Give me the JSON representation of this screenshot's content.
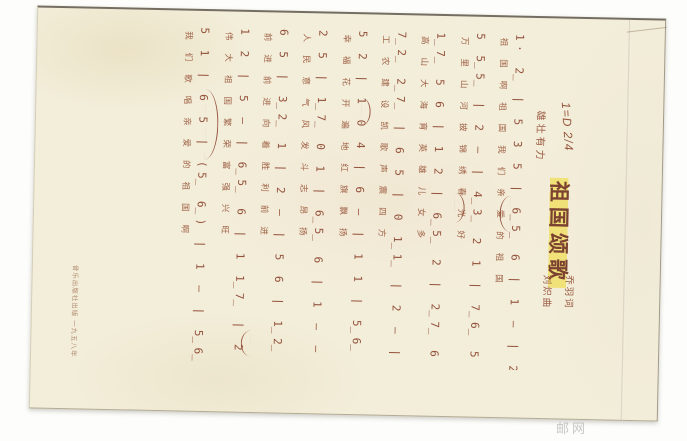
{
  "sheet": {
    "title": "祖国颂歌",
    "key_signature": "1=D 2/4",
    "tempo": "雄壮有力",
    "credit_lyricist": "乔羽词",
    "credit_composer": "刘炽曲",
    "publisher": "音乐出版社出版 一九五八年",
    "watermark": "邮网",
    "ink_color": "#94523c",
    "paper_color": "#f3eeda",
    "highlight_color": "#eeda3e"
  },
  "music": {
    "lines": [
      {
        "notes": "1· 2̲ | 5 3 5 | 6̲5̲ 6 | 1 — | 2̲2̲ 7̲6̲ | 5 — | 3 5 | 2 —",
        "lyrics": "祖国啊祖国我们亲爱的祖国"
      },
      {
        "notes": "5 5̲5̲ | 2 — | 4̲3̲ 2 1 | 7̲6̲ 5 | 5 6̲7̲ | 1 — | 1 (5̲ 6̲ |",
        "lyrics": "万里山河披锦绣春光好"
      },
      {
        "notes": "1̲7̲ 5 6 | 1 2 | 6̲5̲ 2 | 2̲7̲ 6 — | 5 6 1 | 2 — | 5 ·",
        "lyrics": "高山大海育英雄儿女多"
      },
      {
        "notes": "7̲2̲ 2̲7̲ | 6 5 | 0 1̲1̲ | 2 — | 5̲5̲ 3 | 2 1 | 7̲6̲ 5 |",
        "lyrics": "工农建设凯歌声震四方"
      },
      {
        "notes": "5 2 | 1 0 4 | 6 — | 1 1 | 5̲6̲ 5 3 | 2 — | 1̲1̲ 2 |",
        "lyrics": "幸福花开遍地红旗飘扬"
      },
      {
        "notes": "2 5 | 1̲7̲ 0 1 | 6̲5̲ 6 | 1 — — | 2 2 | 5̲5̲ 6 | 1 —",
        "lyrics": "人民意气风发斗志昂扬"
      },
      {
        "notes": "6 5 | 3̲2̲ 1 | 2 — | 5 6 | 1̲2̲ 1̲7̲ | 6 5 | 3 — |",
        "lyrics": "前进前进向着胜利前进"
      },
      {
        "notes": "1 2 | 5 — | 6̲5̲ 6 | 1 1̲7̲ | 2 — | 5 6 | 1 — ‖",
        "lyrics": "伟大祖国繁荣富强兴旺"
      },
      {
        "notes": "5 1 | 6 5 | (5̲ 6̲) | 1 — | 5̲6̲ 5 | 1 — | (6̲ 5̲) ‖",
        "lyrics": "我们歌唱亲爱的祖国啊"
      }
    ]
  }
}
